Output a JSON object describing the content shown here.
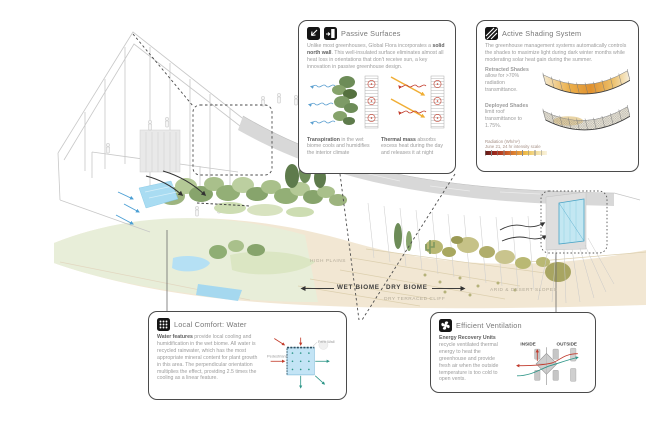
{
  "colors": {
    "box_border": "#4b4b4b",
    "red_arrow": "#c0392b",
    "teal_arrow": "#2e9688",
    "yellow_arrow": "#f0ae35",
    "blue_arrow": "#5b9fd0",
    "water_blue": "#aadcf1",
    "canopy_green": "#8fae74",
    "sand_tan": "#f2e7d3",
    "roof_gray": "#d8d8d8"
  },
  "illustration": {
    "labels": {
      "high_plains": "HIGH PLAINS",
      "wet_biome": "WET BIOME",
      "dry_biome": "DRY BIOME",
      "dry_terraced_cliff": "DRY TERRACED CLIFF",
      "arid_desert_slopes": "ARID & DESERT SLOPES"
    }
  },
  "callouts": {
    "passive_surfaces": {
      "icons": [
        "reflected-heat-icon",
        "insulated-wall-icon"
      ],
      "title": "Passive Surfaces",
      "body_lead": "Unlike most greenhouses, Global Flora incorporates a ",
      "body_bold": "solid north wall",
      "body_rest": ". This well-insulated surface eliminates almost all heat loss in orientations that don't receive sun, a key innovation in passive greenhouse design.",
      "caption_left_bold": "Transpiration",
      "caption_left_rest": " in the wet biome cools and humidifies the interior climate",
      "caption_right_bold": "Thermal mass",
      "caption_right_rest": " absorbs excess heat during the day and releases it at night"
    },
    "active_shading": {
      "icons": [
        "hatched-shade-icon"
      ],
      "title": "Active Shading System",
      "body": "The greenhouse management systems automatically controls the shades to maximize light during dark winter months while moderating solar heat gain during the summer.",
      "retracted_bold": "Retracted Shades",
      "retracted_rest": " allow for >70% radiation transmittance.",
      "deployed_bold": "Deployed Shades",
      "deployed_rest": " limit roof transmittance to 1.75%.",
      "legend_line1": "Radiation (Wh/m²)",
      "legend_line2": "June 21, 24 hr intensity scale"
    },
    "local_comfort": {
      "icons": [
        "evaporation-dots-icon"
      ],
      "title": "Local Comfort: Water",
      "body_bold": "Water features",
      "body_rest": " provide local cooling and humidification in the wet biome. All water is recycled rainwater, which has the most appropriate mineral content for plant growth in this area. The perpendicular orientation multiplies the effect, providing 2.5 times the cooling as a linear feature.",
      "labels": {
        "fern_wall": "Fern Wall",
        "pedestrians": "Pedestrians"
      }
    },
    "efficient_ventilation": {
      "icons": [
        "fan-icon"
      ],
      "title": "Efficient Ventilation",
      "body_bold": "Energy Recovery Units",
      "body_rest": " recycle ventilated thermal energy to heat the greenhouse and provide fresh air when the outside temperature is too cold to open vents.",
      "labels": {
        "inside": "INSIDE",
        "outside": "OUTSIDE"
      }
    }
  }
}
